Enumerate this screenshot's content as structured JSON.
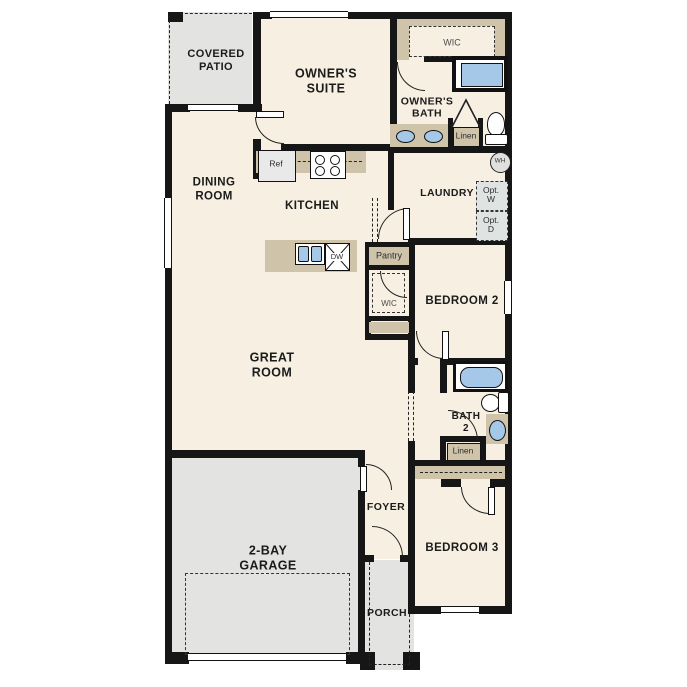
{
  "plan": {
    "title": "single-story-floor-plan",
    "labels": {
      "covered_patio": "COVERED\nPATIO",
      "owners_suite": "OWNER'S\nSUITE",
      "wic_owner": "WIC",
      "owners_bath": "OWNER'S\nBATH",
      "linen_owner": "Linen",
      "water_heater": "WH",
      "dining_room": "DINING\nROOM",
      "kitchen": "KITCHEN",
      "ref": "Ref",
      "dw": "DW",
      "laundry": "LAUNDRY",
      "opt_washer": "Opt.\nW",
      "opt_dryer": "Opt.\nD",
      "pantry": "Pantry",
      "wic_hall": "WIC",
      "bedroom2": "BEDROOM 2",
      "great_room": "GREAT\nROOM",
      "bath2": "BATH\n2",
      "linen_hall": "Linen",
      "foyer": "FOYER",
      "bedroom3": "BEDROOM 3",
      "garage": "2-BAY\nGARAGE",
      "porch": "PORCH"
    },
    "colors": {
      "wall": "#161616",
      "interior": "#f7f0e2",
      "exterior_gray": "#e3e3e1",
      "casework_tan": "#cfc3aa",
      "fixture_blue": "#a5c7e8",
      "appliance_gray": "#e9e9e9",
      "opt_gray": "#dfe3e2"
    }
  }
}
